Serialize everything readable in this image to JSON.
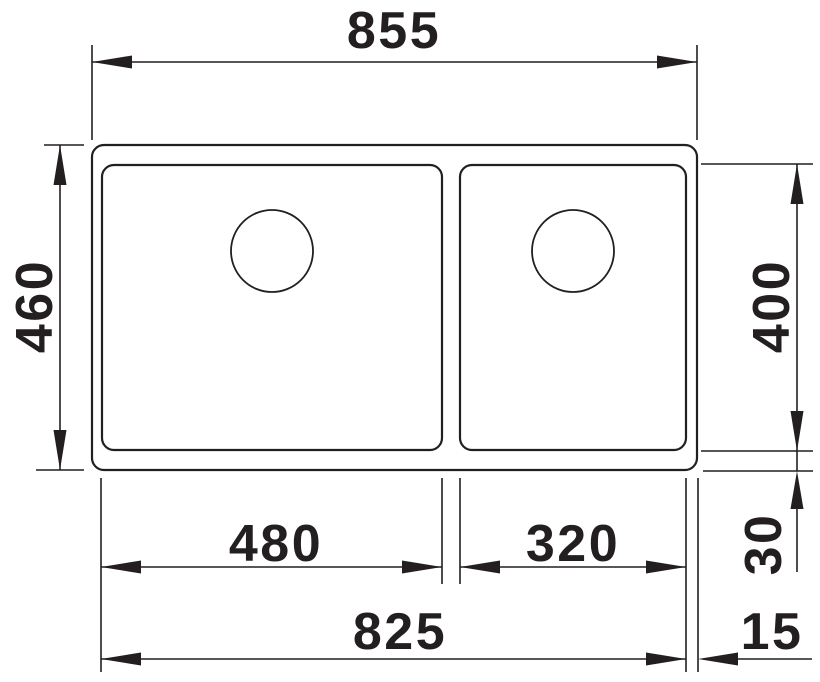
{
  "drawing": {
    "kind": "technical-dimension-drawing",
    "view": "double-bowl-sink-top-view",
    "line_color": "#231f20",
    "background_color": "#ffffff",
    "dimensions": {
      "overall_width": "855",
      "overall_depth": "460",
      "bowl_depth": "400",
      "left_bowl_width": "480",
      "right_bowl_width": "320",
      "bowls_span": "825",
      "bottom_offset": "30",
      "right_offset": "15"
    }
  }
}
